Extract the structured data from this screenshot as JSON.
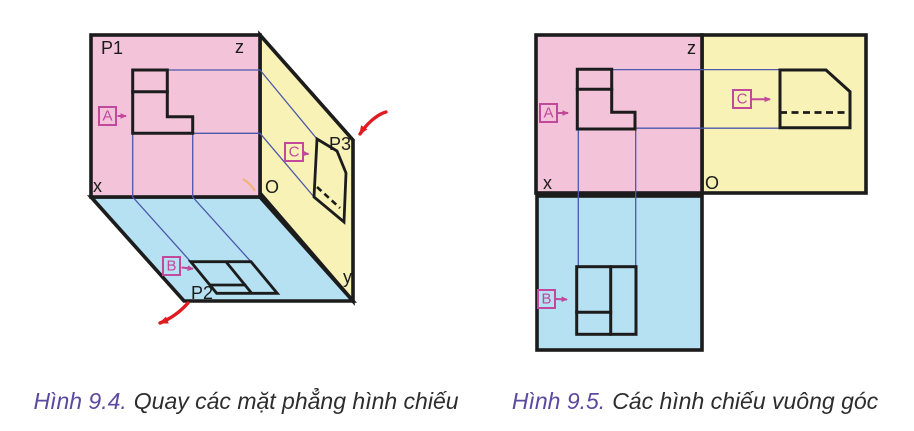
{
  "colors": {
    "frontal_plane_pink": "#f2c3d9",
    "horizontal_plane_blue": "#b5e1f3",
    "profile_plane_yellow": "#f8f2b6",
    "outline_black": "#1c1c1c",
    "projection_line_blue": "#4c58aa",
    "view_label_magenta": "#c2489c",
    "rotation_arrow_red": "#e01b22",
    "caption_accent_purple": "#5b4a9e"
  },
  "fig94": {
    "caption": {
      "label": "Hình 9.4.",
      "text": "Quay các mặt phẳng hình chiếu"
    },
    "labels": {
      "p1": "P1",
      "p2": "P2",
      "p3": "P3",
      "x": "x",
      "y": "y",
      "z": "z",
      "o": "O",
      "a": "A",
      "b": "B",
      "c": "C"
    }
  },
  "fig95": {
    "caption": {
      "label": "Hình 9.5.",
      "text": "Các hình chiếu vuông góc"
    },
    "labels": {
      "x": "x",
      "z": "z",
      "o": "O",
      "a": "A",
      "b": "B",
      "c": "C"
    }
  }
}
